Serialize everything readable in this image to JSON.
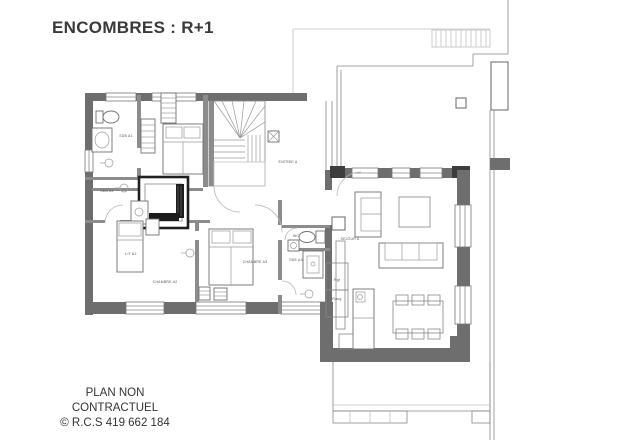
{
  "title": "ENCOMBRES : R+1",
  "footer": {
    "line1": "PLAN NON CONTRACTUEL",
    "line2": "© R.C.S 419 662 184"
  },
  "colors": {
    "background": "#ffffff",
    "wall": "#6e6e6e",
    "wall_dark": "#3d3d3d",
    "thin_line": "#888888",
    "faint_line": "#c2c2c2",
    "label_text": "#555555",
    "title_text": "#3a3a3a",
    "elevator_dark": "#1c1c1c"
  },
  "plan": {
    "room_labels": [
      {
        "text": "SDB A1",
        "x": 126,
        "y": 137
      },
      {
        "text": "SDB A2",
        "x": 107,
        "y": 192
      },
      {
        "text": "LIT A2",
        "x": 131,
        "y": 255
      },
      {
        "text": "CHAMBRE A2",
        "x": 165,
        "y": 283
      },
      {
        "text": "CHAMBRE A3",
        "x": 255,
        "y": 263
      },
      {
        "text": "WC",
        "x": 296,
        "y": 237
      },
      {
        "text": "SDE A3",
        "x": 296,
        "y": 261
      },
      {
        "text": "ENTREE A",
        "x": 288,
        "y": 163
      },
      {
        "text": "SEJOUR A",
        "x": 350,
        "y": 240
      },
      {
        "text": "Rgt",
        "x": 337,
        "y": 281
      },
      {
        "text": "Rang",
        "x": 337,
        "y": 300
      }
    ]
  }
}
